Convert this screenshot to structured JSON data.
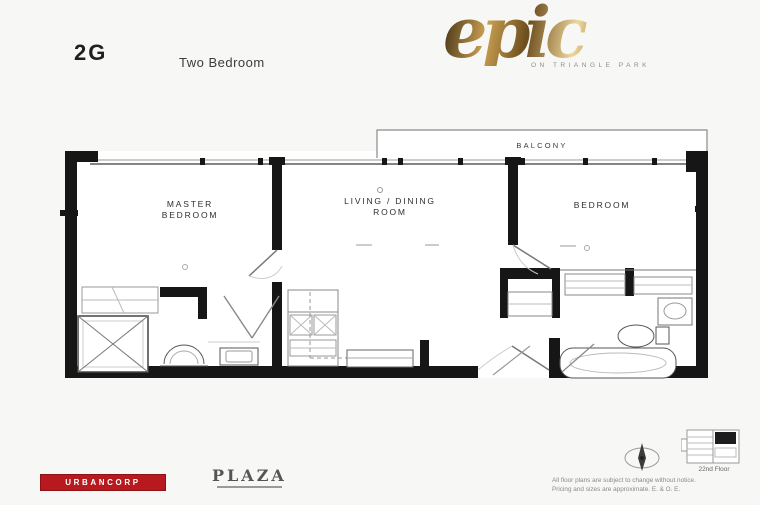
{
  "header": {
    "unit_code": "2G",
    "unit_type": "Two Bedroom"
  },
  "brand": {
    "logo_text": "epic",
    "tagline": "ON TRIANGLE PARK"
  },
  "plan": {
    "balcony": "BALCONY",
    "master_bedroom_line1": "MASTER",
    "master_bedroom_line2": "BEDROOM",
    "living_line1": "LIVING / DINING",
    "living_line2": "ROOM",
    "bedroom": "BEDROOM"
  },
  "keyplan": {
    "floor_label": "22nd Floor"
  },
  "footer": {
    "developer_logo": "URBANCORP",
    "marketing_logo": "PLAZA",
    "disclaimer_line1": "All floor plans are subject to change without notice.",
    "disclaimer_line2": "Pricing and sizes are approximate. E. & O. E."
  },
  "colors": {
    "wall": "#161616",
    "accent_red": "#b8191f",
    "brand_gold": "#b8893c"
  }
}
